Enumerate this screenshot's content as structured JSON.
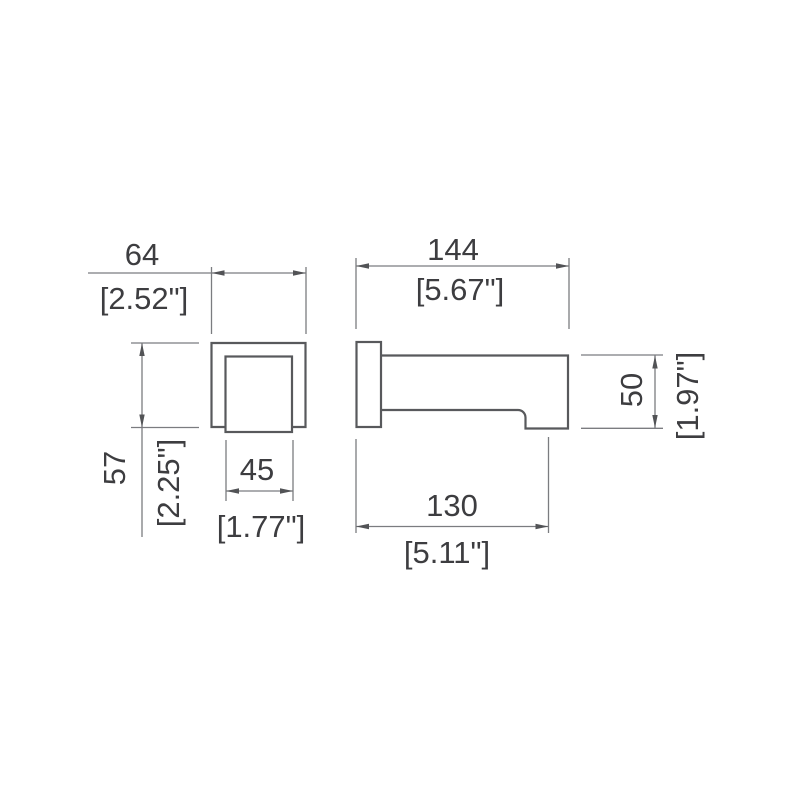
{
  "drawing": {
    "colors": {
      "background": "#ffffff",
      "outline": "#58595c",
      "dimension_line": "#7b7c80",
      "arrow": "#525356",
      "text": "#3d3d40"
    },
    "dimensions": {
      "front_width": {
        "mm": "64",
        "inch": "[2.52\"]"
      },
      "front_height": {
        "mm": "57",
        "inch": "[2.25\"]"
      },
      "inner_width": {
        "mm": "45",
        "inch": "[1.77\"]"
      },
      "side_length": {
        "mm": "144",
        "inch": "[5.67\"]"
      },
      "side_height": {
        "mm": "50",
        "inch": "[1.97\"]"
      },
      "outlet_reach": {
        "mm": "130",
        "inch": "[5.11\"]"
      }
    }
  }
}
